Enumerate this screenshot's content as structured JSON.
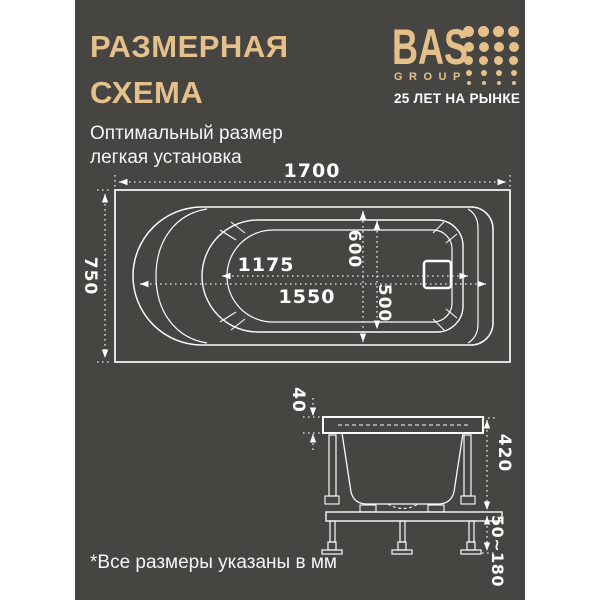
{
  "page": {
    "title_line1": "РАЗМЕРНАЯ",
    "title_line2": "СХЕМА",
    "subtitle_line1": "Оптимальный размер",
    "subtitle_line2": "легкая установка",
    "footnote": "*Все размеры указаны в мм"
  },
  "logo": {
    "name": "BAS",
    "sub": "GROUP",
    "tagline": "25 ЛЕТ НА РЫНКЕ"
  },
  "colors": {
    "panel_bg": "#474542",
    "accent_gold": "#e6c08a",
    "line_white": "#ffffff"
  },
  "dimensions": {
    "top_view": {
      "overall_length": "1700",
      "overall_width": "750",
      "inner_length_upper": "1175",
      "inner_length_lower": "1550",
      "inner_width_upper": "600",
      "inner_width_lower": "500"
    },
    "side_view": {
      "rim_thickness": "40",
      "body_height": "420",
      "feet_height_range": "50~180"
    }
  }
}
